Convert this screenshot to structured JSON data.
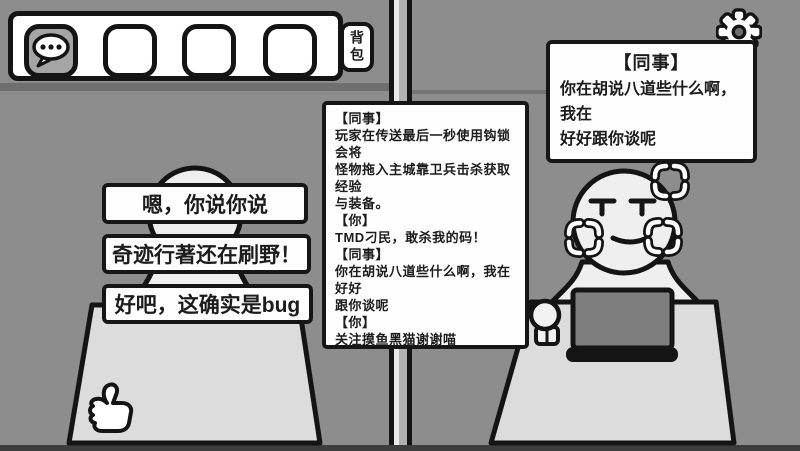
{
  "hotbar": {
    "backpack_label": "背包",
    "slots": [
      {
        "icon": "chat-bubble-icon",
        "selected": true
      },
      {
        "icon": null,
        "selected": false
      },
      {
        "icon": null,
        "selected": false
      },
      {
        "icon": null,
        "selected": false
      }
    ]
  },
  "settings_icon": "gear-icon",
  "colleague_bubble": {
    "title": "【同事】",
    "lines": [
      "你在胡说八道些什么啊，我在",
      "好好跟你谈呢"
    ]
  },
  "chat_log": {
    "lines": [
      "【同事】",
      "玩家在传送最后一秒使用钩锁会将",
      "怪物拖入主城靠卫兵击杀获取经验",
      "与装备。",
      "【你】",
      "TMD刁民，敢杀我的码！",
      "【同事】",
      "你在胡说八道些什么啊，我在好好",
      "跟你谈呢",
      "【你】",
      "关注摸鱼黑猫谢谢喵",
      "【同事】",
      "你在胡说八道些什么啊，我在好好",
      "跟你谈呢",
      "【你】"
    ]
  },
  "player_bubbles": [
    "嗯，你说你说",
    "奇迹行著还在刷野！",
    "好吧，这确实是bug"
  ],
  "colors": {
    "wall": "#8d8d8d",
    "desk": "#dcdcdc",
    "character": "#efefef",
    "laptop_screen": "#7e7e7e",
    "ink": "#161616",
    "panel": "#fefefe",
    "slot_selected": "#a5a5a5"
  }
}
